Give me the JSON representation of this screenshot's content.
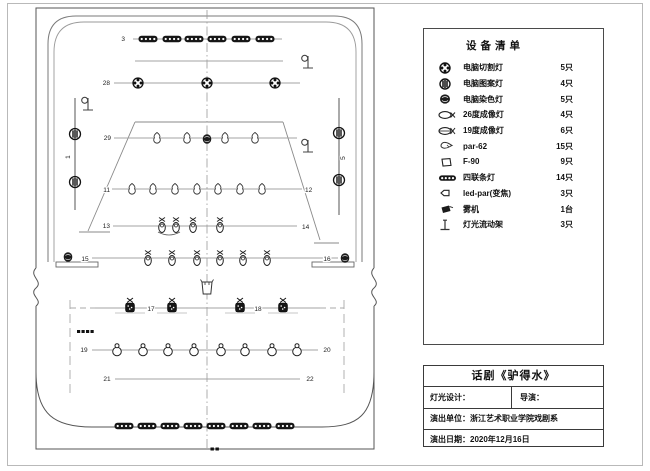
{
  "legend": {
    "title": "设备清单",
    "items": [
      {
        "icon": "moving-cut-light",
        "name": "电脑切割灯",
        "qty": "5只"
      },
      {
        "icon": "moving-pattern-light",
        "name": "电脑图案灯",
        "qty": "4只"
      },
      {
        "icon": "moving-wash-light",
        "name": "电脑染色灯",
        "qty": "5只"
      },
      {
        "icon": "profile-26",
        "name": "26度成像灯",
        "qty": "4只"
      },
      {
        "icon": "profile-19",
        "name": "19度成像灯",
        "qty": "6只"
      },
      {
        "icon": "par-62",
        "name": "par-62",
        "qty": "15只"
      },
      {
        "icon": "f-90",
        "name": "F-90",
        "qty": "9只"
      },
      {
        "icon": "strip-light",
        "name": "四联条灯",
        "qty": "14只"
      },
      {
        "icon": "led-par",
        "name": "led-par(变焦)",
        "qty": "3只"
      },
      {
        "icon": "fog-machine",
        "name": "雾机",
        "qty": "1台"
      },
      {
        "icon": "light-stand",
        "name": "灯光流动架",
        "qty": "3只"
      }
    ]
  },
  "title_block": {
    "title": "话剧《驴得水》",
    "lighting_design_label": "灯光设计：",
    "director_label": "导演：",
    "unit_label": "演出单位：浙江艺术职业学院戏剧系",
    "date_label": "演出日期：2020年12月16日"
  },
  "plot": {
    "rows": [
      {
        "id": "pipe-3",
        "label": "3",
        "lx": 125,
        "ly": 41,
        "line": [
          133,
          39,
          282,
          39
        ],
        "type": "strip",
        "y": 39,
        "xs": [
          148,
          172,
          194,
          217,
          241,
          265
        ]
      },
      {
        "id": "batten",
        "label": "",
        "line": [
          135,
          61,
          283,
          61
        ],
        "type": "none",
        "xs": []
      },
      {
        "id": "pipe-28",
        "label": "28",
        "lx": 110,
        "ly": 85,
        "line": [
          114,
          83,
          300,
          83
        ],
        "type": "moving-cut",
        "y": 83,
        "xs": [
          138,
          207,
          275
        ]
      },
      {
        "id": "pipe-29",
        "label": "29",
        "lx": 111,
        "ly": 140,
        "line": [
          114,
          138,
          297,
          138
        ],
        "type": "par",
        "y": 138,
        "xs": [
          157,
          187,
          225,
          255
        ],
        "extra": {
          "type": "wash",
          "x": 207,
          "y": 139
        }
      },
      {
        "id": "pipe-11",
        "label": "11",
        "lx": 110,
        "ly": 192,
        "label2": "12",
        "l2x": 305,
        "l2y": 192,
        "line": [
          112,
          189,
          302,
          189
        ],
        "type": "par",
        "y": 189,
        "xs": [
          132,
          153,
          175,
          197,
          218,
          240,
          262
        ]
      },
      {
        "id": "pipe-13",
        "label": "13",
        "lx": 110,
        "ly": 228,
        "label2": "14",
        "l2x": 302,
        "l2y": 229,
        "line": [
          113,
          226,
          297,
          226
        ],
        "type": "profile",
        "y": 227,
        "xs": [
          162,
          176,
          193,
          220
        ],
        "pairArc": [
          158,
          232,
          180,
          232
        ]
      },
      {
        "id": "pipe-15",
        "label": "15",
        "lxm": 85,
        "ly": 261,
        "label2": "16",
        "l2xm": 327,
        "l2y": 261,
        "line": [
          92,
          258,
          338,
          258
        ],
        "type": "profile",
        "y": 260,
        "xs": [
          148,
          172,
          197,
          220,
          243,
          267
        ],
        "washes": [
          [
            68,
            257
          ],
          [
            345,
            258
          ]
        ]
      },
      {
        "id": "row-17",
        "label": "17",
        "lxm": 151,
        "ly": 311,
        "label2": "18",
        "l2xm": 258,
        "l2y": 311,
        "line": [
          95,
          308,
          320,
          308
        ],
        "type": "led-par",
        "y": 307,
        "xs": [
          130,
          172,
          240,
          283
        ]
      },
      {
        "id": "row-19",
        "label": "19",
        "lxm": 84,
        "ly": 352,
        "label2": "20",
        "l2xm": 327,
        "l2y": 352,
        "line": [
          92,
          350,
          318,
          350
        ],
        "type": "f-90",
        "y": 350,
        "xs": [
          117,
          143,
          168,
          194,
          221,
          245,
          272,
          297
        ]
      },
      {
        "id": "row-21",
        "label": "21",
        "lxm": 107,
        "ly": 381,
        "label2": "22",
        "l2xm": 310,
        "l2y": 381,
        "line": [
          115,
          379,
          300,
          379
        ],
        "type": "none",
        "xs": []
      },
      {
        "id": "strip-bottom",
        "label": "",
        "line": [],
        "type": "strip",
        "y": 426,
        "xs": [
          124,
          147,
          170,
          193,
          216,
          239,
          262,
          285
        ]
      }
    ],
    "booms": [
      {
        "label": "1",
        "x": 75,
        "y1": 98,
        "y2": 210,
        "lights": [
          134,
          182
        ],
        "tx": 70,
        "ty": 157
      },
      {
        "label": "5",
        "x": 339,
        "y1": 98,
        "y2": 215,
        "lights": [
          133,
          180
        ],
        "tx": 345,
        "ty": 158
      }
    ],
    "stands": [
      [
        88,
        108
      ],
      [
        308,
        66
      ],
      [
        308,
        150
      ]
    ],
    "fog": [
      207,
      288
    ]
  }
}
